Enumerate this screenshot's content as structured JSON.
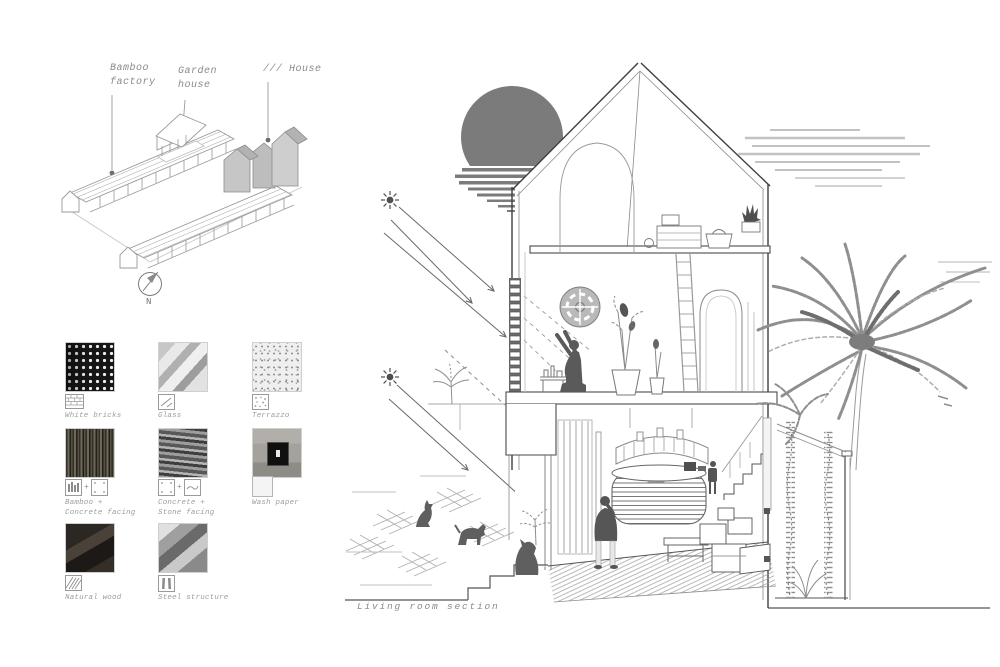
{
  "site_plan": {
    "labels": [
      {
        "line1": "Bamboo",
        "line2": "factory"
      },
      {
        "line1": "Garden",
        "line2": "house"
      },
      {
        "line1": "/// House",
        "line2": ""
      }
    ],
    "compass": "N"
  },
  "materials": {
    "plus": "+",
    "items": [
      {
        "line1": "White bricks",
        "line2": "",
        "icons": [
          "brick-pattern-icon"
        ]
      },
      {
        "line1": "Glass",
        "line2": "",
        "icons": [
          "glass-icon"
        ]
      },
      {
        "line1": "Terrazzo",
        "line2": "",
        "icons": [
          "terrazzo-icon"
        ]
      },
      {
        "line1": "Bamboo +",
        "line2": "Concrete facing",
        "icons": [
          "bamboo-icon",
          "concrete-facing-icon"
        ]
      },
      {
        "line1": "Concrete +",
        "line2": "Stone facing",
        "icons": [
          "concrete-facing-icon",
          "stone-facing-icon"
        ]
      },
      {
        "line1": "Wash paper",
        "line2": "",
        "icons": [
          "wash-paper-icon"
        ]
      },
      {
        "line1": "Natural wood",
        "line2": "",
        "icons": [
          "wood-hatch-icon"
        ]
      },
      {
        "line1": "Steel structure",
        "line2": "",
        "icons": [
          "steel-beam-icon"
        ]
      }
    ]
  },
  "section": {
    "caption": "Living room section"
  },
  "colors": {
    "sun": "#7b7b7b",
    "silhouette": "#5a5a5a",
    "house_fill": "#c8c8c8",
    "line_dark": "#4a4a4a",
    "line_mid": "#8f8f8f",
    "label_text": "#8a8a8a"
  }
}
